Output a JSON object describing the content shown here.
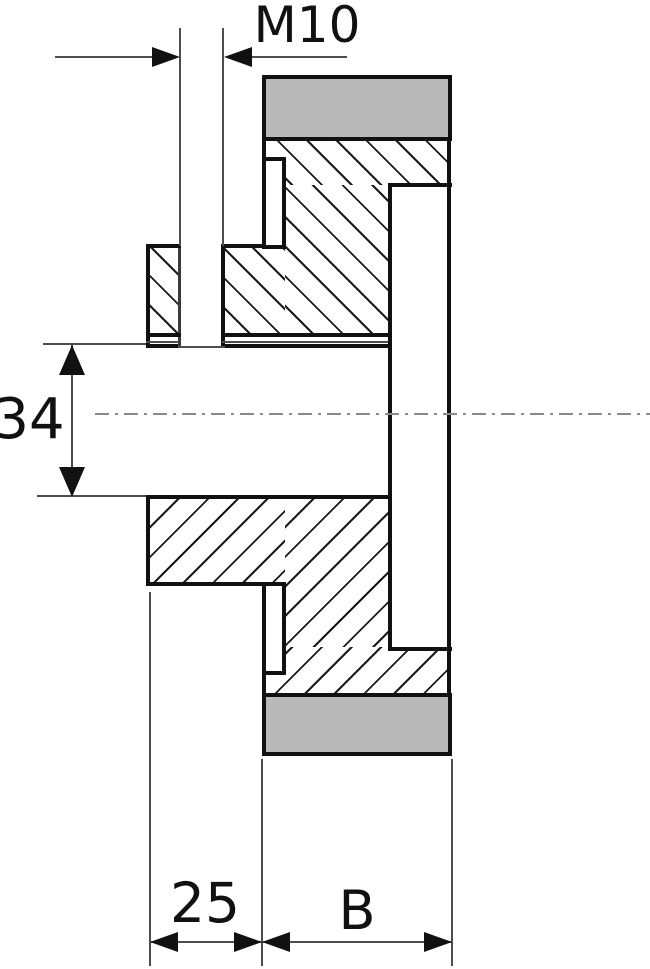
{
  "drawing": {
    "description": "sectional view of a spur gear with hub, bore, keyway and tapped set-screw hole",
    "labels": {
      "thread": "M10",
      "bore_diameter": "34",
      "hub_projection": "25",
      "face_width": "B"
    },
    "colors": {
      "teeth_band": "#b9b9b9",
      "outline": "#111111",
      "dimension": "#4d4d4d",
      "centerline": "#8a8a8a",
      "hatch": "#1a1a1a",
      "background": "#ffffff"
    }
  }
}
